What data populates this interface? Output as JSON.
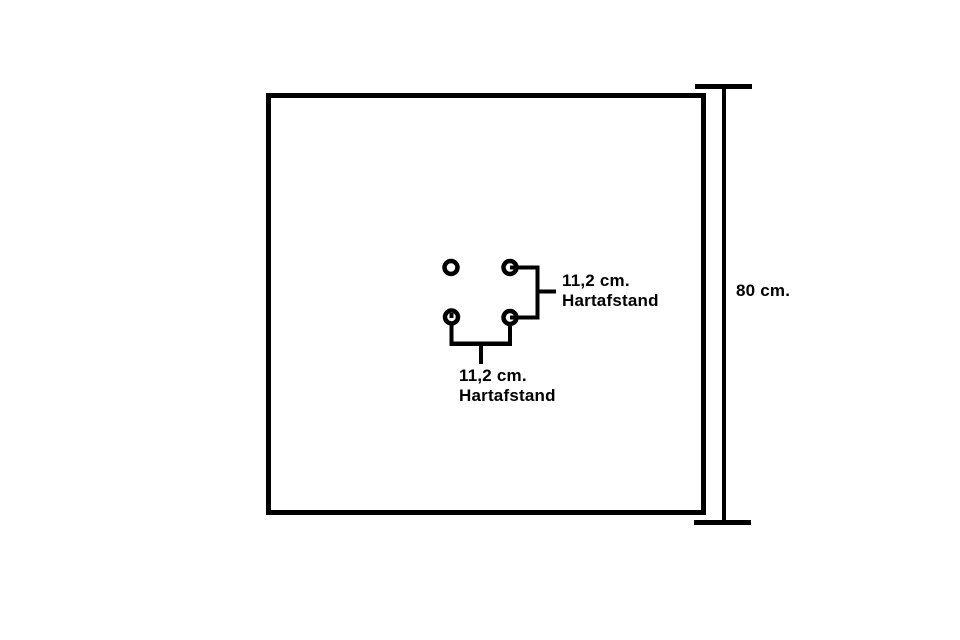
{
  "canvas": {
    "background_color": "#ffffff",
    "line_color": "#000000"
  },
  "plate": {
    "shape": "square",
    "holes_count": "4"
  },
  "labels": {
    "plate_height": "80 cm.",
    "vertical_hole_spacing": {
      "line1": "11,2 cm.",
      "line2": "Hartafstand"
    },
    "horizontal_hole_spacing": {
      "line1": "11,2 cm.",
      "line2": "Hartafstand"
    }
  }
}
